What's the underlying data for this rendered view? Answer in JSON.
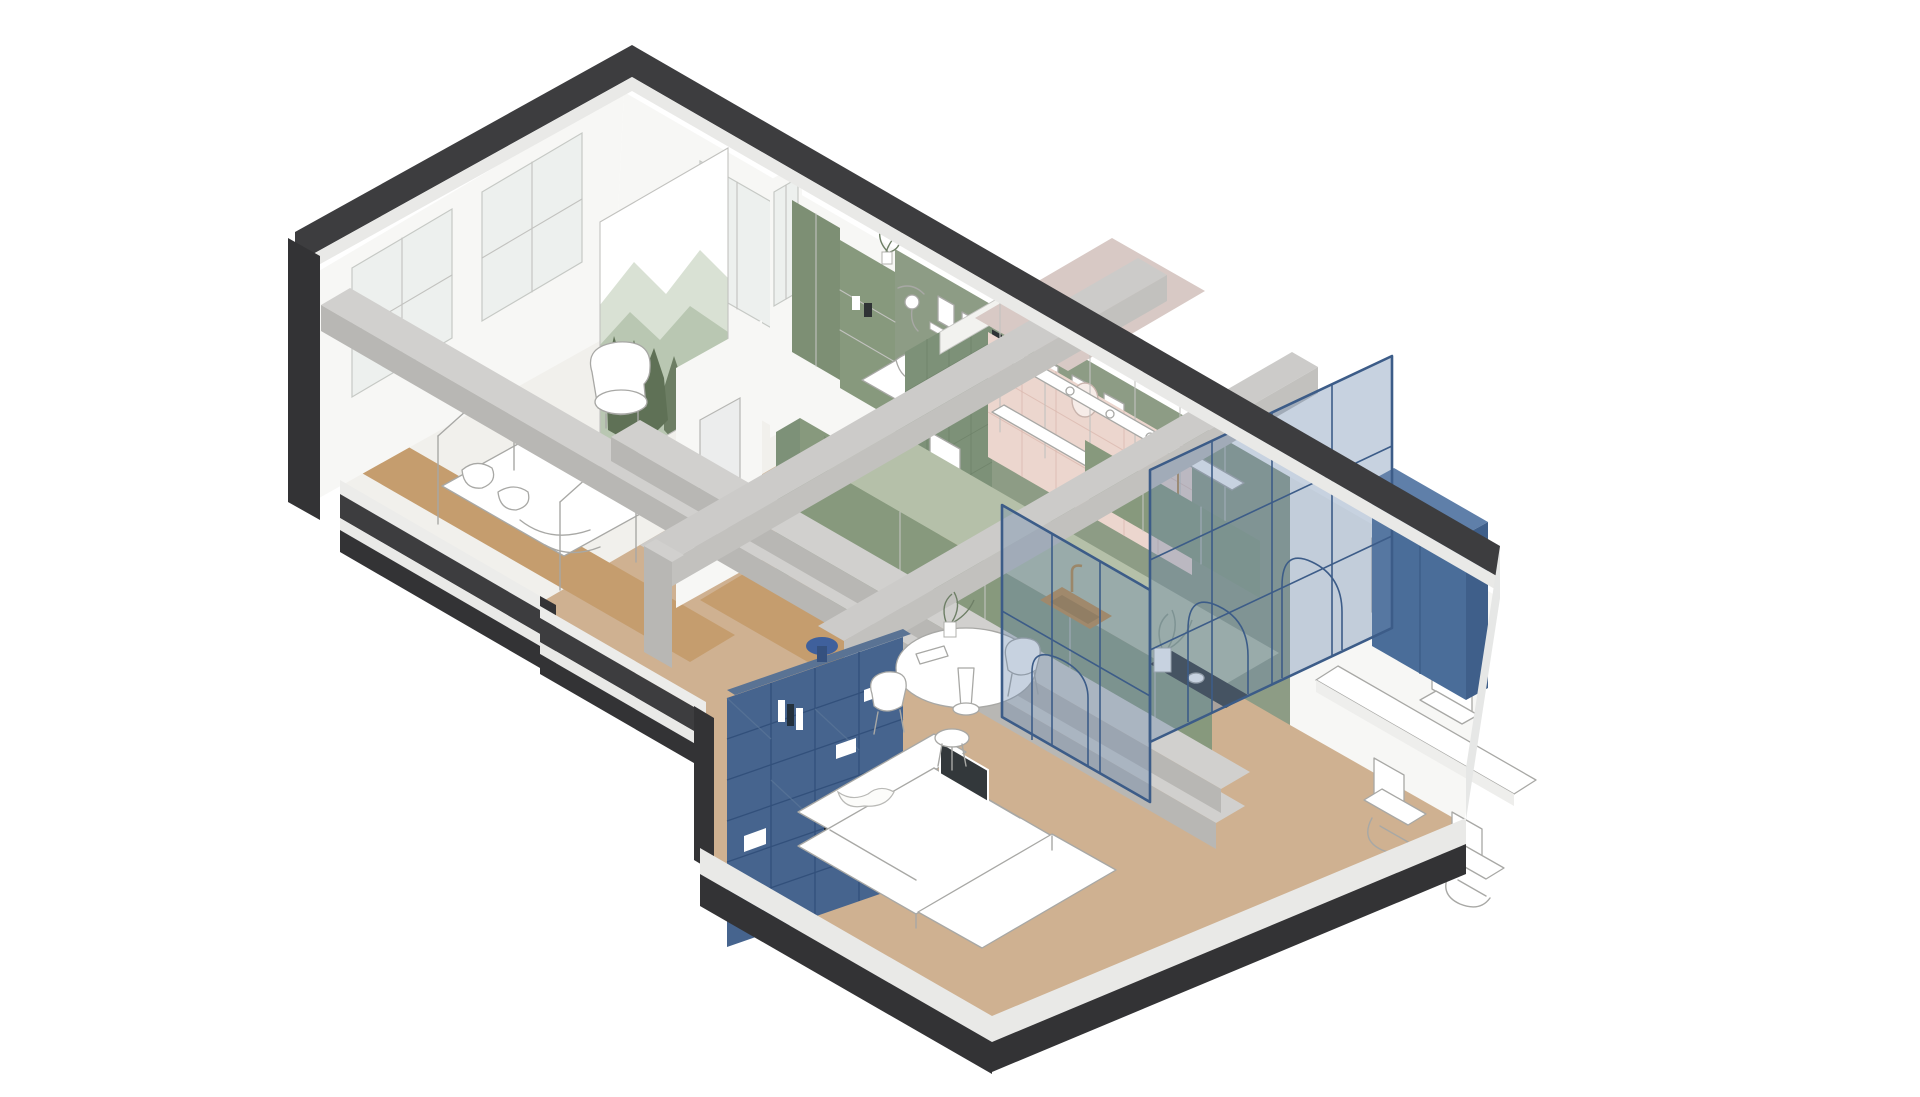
{
  "title": "Axonometric cutaway floor plan of an apartment",
  "colors": {
    "page_bg": "#ffffff",
    "wall_cap": "#3d3d3f",
    "wall_white": "#f7f7f5",
    "slab_white": "#e9e9e7",
    "floor_white": "#f1f0ec",
    "floor_tan": "#cfb191",
    "wood": "#c59d6e",
    "green_wall": "#8d9c85",
    "green_cabinet": "#87997d",
    "green_dark": "#7d9178",
    "green_wardrobe": "#7d8f74",
    "counter_top": "#b5c0a9",
    "pink_cap": "#d8c9c5",
    "pink_tile": "#ecd6ce",
    "pink_grid": "#d8b4aa",
    "blue_shelf": "#46648e",
    "blue_grid": "#32507b",
    "blue_shelf_top": "#5a7394",
    "blue_cabinet": "#4a6d99",
    "blue_cabinet_side": "#3f5f8a",
    "blue_cabinet_top": "#5f7fa9",
    "blue_frame": "#3c5c88",
    "glass_blue": "rgba(108,138,173,0.38)",
    "concrete_top": "#d1d0ce",
    "concrete_side": "#b8b7b4",
    "concrete_light": "#cccbc9",
    "brass": "#c08a45",
    "hob_black": "#2e3335",
    "stroke_light": "#a8a8a5",
    "glass_window": "#edf0ee",
    "mural_wash1": "#d9e1d4",
    "mural_wash2": "#b9c7b2",
    "mural_trees": "#5f7156",
    "stool_blue": "#3f609c",
    "white": "#ffffff"
  },
  "scene": {
    "style": "isometric cutaway, dark-capped white walls, concrete beam grid",
    "rooms": [
      {
        "name": "children-bedroom",
        "items": [
          "house-frame-bed",
          "pillows",
          "wood-floor-strip",
          "windows"
        ]
      },
      {
        "name": "reading-nook",
        "items": [
          "mountain-mural",
          "white-armchair",
          "wood-bench"
        ]
      },
      {
        "name": "main-bedroom",
        "items": [
          "green-feature-wall",
          "bed",
          "wardrobe",
          "shelf-unit",
          "picture-ledge",
          "wall-lamp",
          "plant"
        ]
      },
      {
        "name": "wc",
        "items": [
          "green-tiled-wall",
          "toilet",
          "green-door"
        ]
      },
      {
        "name": "bathroom",
        "items": [
          "pink-tiles",
          "mirror",
          "brass-shower"
        ]
      },
      {
        "name": "kitchen",
        "items": [
          "green-cabinets",
          "brass-sink",
          "black-hob",
          "open-shelving-with-jars"
        ]
      },
      {
        "name": "hallway",
        "items": [
          "doorway",
          "concrete-column"
        ]
      },
      {
        "name": "living-room",
        "items": [
          "navy-grid-bookshelf",
          "white-corner-sofa",
          "laptop",
          "blue-side-stool"
        ]
      },
      {
        "name": "dining-area",
        "items": [
          "round-white-table",
          "chairs",
          "stool",
          "plant"
        ]
      },
      {
        "name": "home-office",
        "items": [
          "glass-partition-arched-doors",
          "navy-cabinet",
          "floating-desk",
          "laptop",
          "two-cantilever-chairs",
          "wall-frames"
        ]
      }
    ]
  }
}
